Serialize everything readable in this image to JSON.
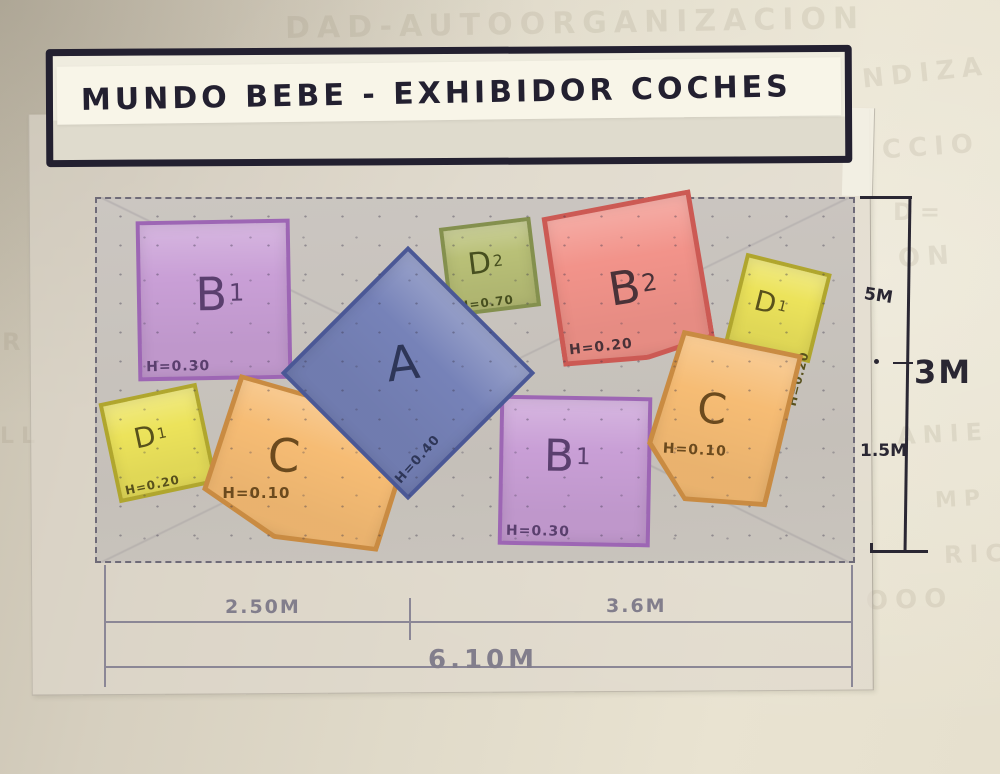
{
  "title": "MUNDO BEBE - EXHIBIDOR COCHES",
  "shapes": [
    {
      "id": "b1-top-left",
      "label": "B",
      "sub": "1",
      "height_label": "H=0.30",
      "fill": "#c99fd6",
      "edge": "#9d66b4",
      "ink": "#5a3f6e"
    },
    {
      "id": "a-center",
      "label": "A",
      "sub": "",
      "height_label": "H=0.40",
      "fill": "#7682b8",
      "edge": "#4b5896",
      "ink": "#2e3658"
    },
    {
      "id": "d2-top",
      "label": "D",
      "sub": "2",
      "height_label": "H=0.70",
      "fill": "#b9c077",
      "edge": "#84904e",
      "ink": "#474f1f"
    },
    {
      "id": "b2-top-right",
      "label": "B",
      "sub": "2",
      "height_label": "H=0.20",
      "fill": "#f2938a",
      "edge": "#cc5a54",
      "ink": "#4a3238"
    },
    {
      "id": "d1-right",
      "label": "D",
      "sub": "1",
      "height_label": "H=0.20",
      "fill": "#ece35b",
      "edge": "#b0a62e",
      "ink": "#58511c"
    },
    {
      "id": "c-right",
      "label": "C",
      "sub": "",
      "height_label": "H=0.10",
      "fill": "#f6bc74",
      "edge": "#c98b42",
      "ink": "#6b4a1e"
    },
    {
      "id": "b1-bottom",
      "label": "B",
      "sub": "1",
      "height_label": "H=0.30",
      "fill": "#c99fd6",
      "edge": "#9d66b4",
      "ink": "#5a3f6e"
    },
    {
      "id": "c-left",
      "label": "C",
      "sub": "",
      "height_label": "H=0.10",
      "fill": "#f6bc74",
      "edge": "#c98b42",
      "ink": "#6b4a1e"
    },
    {
      "id": "d1-left",
      "label": "D",
      "sub": "1",
      "height_label": "H=0.20",
      "fill": "#ece35b",
      "edge": "#b0a62e",
      "ink": "#58511c"
    }
  ],
  "dimensions": {
    "right_upper": "5M",
    "right_total": "3M",
    "right_lower": "1.5M",
    "bottom_left": "2.50M",
    "bottom_right": "3.6M",
    "bottom_total": "6.10M"
  },
  "ghost_text": [
    {
      "text": "DAD-AUTOORGANIZACION",
      "x": 285,
      "y": 6,
      "size": 30,
      "rot": -1
    },
    {
      "text": "NDIZA",
      "x": 862,
      "y": 58,
      "size": 26,
      "rot": -6
    },
    {
      "text": "CCIO",
      "x": 882,
      "y": 132,
      "size": 26,
      "rot": -4
    },
    {
      "text": "D=",
      "x": 893,
      "y": 198,
      "size": 24,
      "rot": 0
    },
    {
      "text": "ON",
      "x": 898,
      "y": 242,
      "size": 26,
      "rot": -4
    },
    {
      "text": "ANIE",
      "x": 897,
      "y": 420,
      "size": 24,
      "rot": -3
    },
    {
      "text": "MP",
      "x": 935,
      "y": 487,
      "size": 22,
      "rot": -3
    },
    {
      "text": "RIC",
      "x": 944,
      "y": 540,
      "size": 24,
      "rot": -2
    },
    {
      "text": "OOO",
      "x": 866,
      "y": 585,
      "size": 26,
      "rot": -2
    },
    {
      "text": "R",
      "x": 2,
      "y": 328,
      "size": 24,
      "rot": 0
    },
    {
      "text": "LL",
      "x": 0,
      "y": 424,
      "size": 22,
      "rot": 0
    }
  ],
  "palette": {
    "paper": "#ded7c6",
    "vellum": "#ded9cb",
    "floor_wash": "#c8c3bc",
    "ink": "#2a2733",
    "pencil": "#8b8796"
  }
}
